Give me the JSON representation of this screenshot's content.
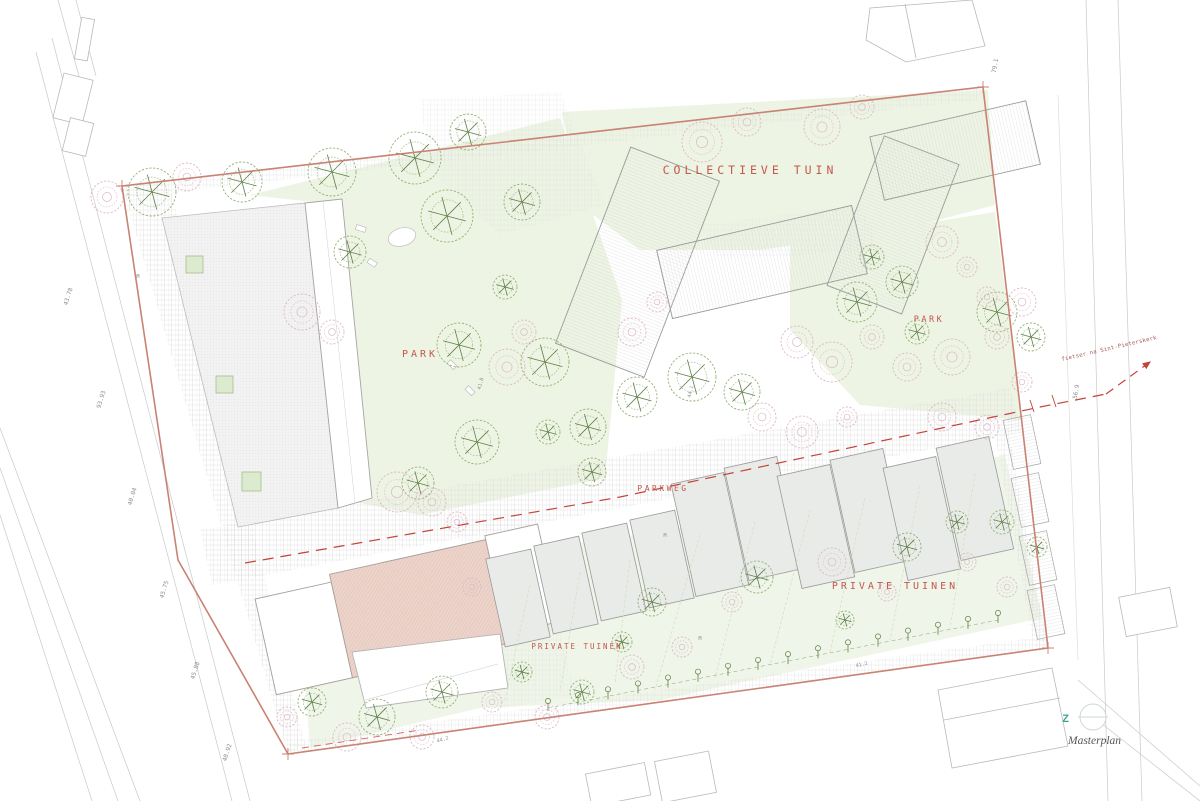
{
  "plan": {
    "caption": {
      "text": "Masterplan"
    },
    "compass": {
      "letter": "Z"
    },
    "labels": [
      {
        "id": "collectieve-tuin",
        "text": "COLLECTIEVE TUIN",
        "x": 750,
        "y": 174,
        "size": 11.5,
        "ls": 4,
        "rot": 0,
        "anchor": "middle",
        "font": "mono"
      },
      {
        "id": "park-west",
        "text": "PARK",
        "x": 420,
        "y": 357,
        "size": 10,
        "ls": 3,
        "rot": 0,
        "anchor": "middle",
        "font": "mono"
      },
      {
        "id": "park-east",
        "text": "PARK",
        "x": 929,
        "y": 322,
        "size": 8.5,
        "ls": 2.5,
        "rot": 0,
        "anchor": "middle",
        "font": "mono"
      },
      {
        "id": "parkweg",
        "text": "PARKWEG",
        "x": 663,
        "y": 491,
        "size": 8,
        "ls": 2.5,
        "rot": 0,
        "anchor": "middle",
        "font": "mono"
      },
      {
        "id": "private-tuinen-east",
        "text": "PRIVATE TUINEN",
        "x": 895,
        "y": 589,
        "size": 10,
        "ls": 3,
        "rot": 0,
        "anchor": "middle",
        "font": "mono"
      },
      {
        "id": "private-tuinen-west",
        "text": "PRIVATE TUINEN",
        "x": 577,
        "y": 649,
        "size": 7.5,
        "ls": 2,
        "rot": 0,
        "anchor": "middle",
        "font": "mono"
      },
      {
        "id": "route-annotation",
        "text": "fietser na Sint-Pieterskerk",
        "x": 1062,
        "y": 361,
        "size": 5.5,
        "ls": 0.3,
        "rot": -13,
        "anchor": "start",
        "font": "mono",
        "color": "#a6564c"
      }
    ],
    "dimensions": [
      {
        "value": "43.78",
        "x": 70,
        "y": 297,
        "rot": -73
      },
      {
        "value": "93.93",
        "x": 103,
        "y": 400,
        "rot": -73
      },
      {
        "value": "40.04",
        "x": 134,
        "y": 497,
        "rot": -73
      },
      {
        "value": "45.75",
        "x": 166,
        "y": 590,
        "rot": -73
      },
      {
        "value": "45.88",
        "x": 197,
        "y": 671,
        "rot": -73
      },
      {
        "value": "48.92",
        "x": 229,
        "y": 753,
        "rot": -73
      },
      {
        "value": "79.1",
        "x": 997,
        "y": 66,
        "rot": -80
      },
      {
        "value": "56.9",
        "x": 1078,
        "y": 392,
        "rot": -80
      },
      {
        "value": "41.8",
        "x": 482,
        "y": 384,
        "rot": -75,
        "s": 5
      },
      {
        "value": "44.1",
        "x": 692,
        "y": 392,
        "rot": -75,
        "s": 5
      },
      {
        "value": "44.2",
        "x": 443,
        "y": 741,
        "rot": -14,
        "s": 5
      },
      {
        "value": "41.2",
        "x": 862,
        "y": 666,
        "rot": -12,
        "s": 5
      },
      {
        "value": "M",
        "x": 138,
        "y": 278,
        "rot": 0,
        "s": 5
      },
      {
        "value": "M",
        "x": 665,
        "y": 537,
        "rot": 0,
        "s": 5
      },
      {
        "value": "M",
        "x": 700,
        "y": 640,
        "rot": 0,
        "s": 5
      }
    ],
    "trees": [
      [
        152,
        192,
        24,
        "g"
      ],
      [
        242,
        182,
        20,
        "g"
      ],
      [
        332,
        172,
        24,
        "g"
      ],
      [
        415,
        158,
        26,
        "g"
      ],
      [
        468,
        132,
        18,
        "g"
      ],
      [
        350,
        252,
        16,
        "g"
      ],
      [
        447,
        216,
        26,
        "g"
      ],
      [
        522,
        202,
        18,
        "g"
      ],
      [
        459,
        345,
        22,
        "g"
      ],
      [
        545,
        362,
        24,
        "g"
      ],
      [
        588,
        427,
        18,
        "g"
      ],
      [
        477,
        442,
        22,
        "g"
      ],
      [
        418,
        483,
        16,
        "g"
      ],
      [
        637,
        397,
        20,
        "g"
      ],
      [
        692,
        377,
        24,
        "g"
      ],
      [
        742,
        392,
        18,
        "g"
      ],
      [
        592,
        472,
        14,
        "g"
      ],
      [
        548,
        432,
        12,
        "g"
      ],
      [
        505,
        287,
        12,
        "g"
      ],
      [
        857,
        302,
        20,
        "g"
      ],
      [
        902,
        282,
        16,
        "g"
      ],
      [
        997,
        312,
        20,
        "g"
      ],
      [
        1031,
        337,
        14,
        "g"
      ],
      [
        917,
        332,
        12,
        "g"
      ],
      [
        872,
        257,
        12,
        "g"
      ],
      [
        652,
        602,
        14,
        "g"
      ],
      [
        757,
        577,
        16,
        "g"
      ],
      [
        907,
        547,
        14,
        "g"
      ],
      [
        957,
        522,
        11,
        "g"
      ],
      [
        1002,
        522,
        12,
        "g"
      ],
      [
        442,
        692,
        16,
        "g"
      ],
      [
        377,
        717,
        18,
        "g"
      ],
      [
        312,
        702,
        14,
        "g"
      ],
      [
        582,
        692,
        12,
        "g"
      ],
      [
        522,
        672,
        10,
        "g"
      ],
      [
        622,
        642,
        10,
        "g"
      ],
      [
        1037,
        547,
        10,
        "g"
      ],
      [
        845,
        620,
        9,
        "g"
      ],
      [
        107,
        197,
        16,
        "p"
      ],
      [
        187,
        177,
        14,
        "p"
      ],
      [
        302,
        312,
        18,
        "p"
      ],
      [
        332,
        332,
        12,
        "p"
      ],
      [
        397,
        492,
        20,
        "p"
      ],
      [
        432,
        502,
        14,
        "p"
      ],
      [
        507,
        367,
        18,
        "p"
      ],
      [
        524,
        332,
        12,
        "p"
      ],
      [
        632,
        332,
        14,
        "p"
      ],
      [
        657,
        302,
        10,
        "p"
      ],
      [
        702,
        142,
        20,
        "p"
      ],
      [
        747,
        122,
        14,
        "p"
      ],
      [
        822,
        127,
        18,
        "p"
      ],
      [
        862,
        107,
        12,
        "p"
      ],
      [
        942,
        242,
        16,
        "p"
      ],
      [
        967,
        267,
        10,
        "p"
      ],
      [
        797,
        342,
        16,
        "p"
      ],
      [
        832,
        362,
        20,
        "p"
      ],
      [
        872,
        337,
        12,
        "p"
      ],
      [
        907,
        367,
        14,
        "p"
      ],
      [
        952,
        357,
        18,
        "p"
      ],
      [
        997,
        337,
        12,
        "p"
      ],
      [
        1022,
        302,
        14,
        "p"
      ],
      [
        987,
        297,
        10,
        "p"
      ],
      [
        762,
        417,
        14,
        "p"
      ],
      [
        802,
        432,
        16,
        "p"
      ],
      [
        847,
        417,
        10,
        "p"
      ],
      [
        942,
        417,
        14,
        "p"
      ],
      [
        987,
        427,
        12,
        "p"
      ],
      [
        1022,
        382,
        10,
        "p"
      ],
      [
        347,
        737,
        14,
        "p"
      ],
      [
        422,
        737,
        12,
        "p"
      ],
      [
        492,
        702,
        10,
        "p"
      ],
      [
        547,
        717,
        12,
        "p"
      ],
      [
        632,
        667,
        12,
        "p"
      ],
      [
        682,
        647,
        10,
        "p"
      ],
      [
        832,
        562,
        14,
        "p"
      ],
      [
        732,
        602,
        10,
        "p"
      ],
      [
        887,
        592,
        9,
        "p"
      ],
      [
        967,
        562,
        9,
        "p"
      ],
      [
        1007,
        587,
        10,
        "p"
      ],
      [
        287,
        717,
        10,
        "p"
      ],
      [
        457,
        522,
        10,
        "p"
      ],
      [
        472,
        587,
        9,
        "p"
      ]
    ],
    "garden_lines": [
      [
        700,
        535,
        655,
        690
      ],
      [
        755,
        522,
        715,
        678
      ],
      [
        810,
        510,
        770,
        665
      ],
      [
        865,
        498,
        830,
        652
      ],
      [
        920,
        486,
        890,
        640
      ],
      [
        975,
        474,
        950,
        628
      ],
      [
        530,
        585,
        505,
        700
      ],
      [
        580,
        572,
        560,
        692
      ],
      [
        630,
        560,
        615,
        683
      ]
    ],
    "espalier_row": {
      "x1": 548,
      "y1": 708,
      "x2": 998,
      "y2": 620,
      "count": 16
    }
  },
  "colors": {
    "boundary": "#c98273",
    "label": "#c4574e",
    "route": "#c2433a",
    "tree_green": "#93b273",
    "tree_core": "#5d7f45",
    "tree_blossom": "#ddb9c6",
    "park_fill": "#edf4e3",
    "garden_fill": "#eff5e8",
    "building_outline": "#9b9b9b",
    "housing_fill": "#e9ebe8",
    "pink_building": "#ecd4cb",
    "compass": "#3fa294",
    "context_line": "#c9c9c9",
    "dimension_text": "#8f8f8f",
    "caption_text": "#555555"
  }
}
